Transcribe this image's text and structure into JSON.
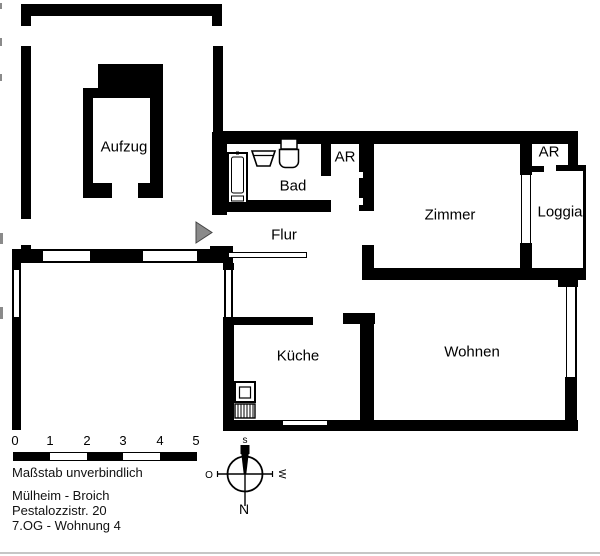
{
  "plan": {
    "title": "Wohnungsgrundriss",
    "rooms": {
      "aufzug": "Aufzug",
      "bad": "Bad",
      "ar1": "AR",
      "zimmer": "Zimmer",
      "ar2": "AR",
      "loggia": "Loggia",
      "flur": "Flur",
      "kueche": "Küche",
      "wohnen": "Wohnen"
    },
    "scale_bar": {
      "ticks": [
        "0",
        "1",
        "2",
        "3",
        "4",
        "5"
      ],
      "note": "Maßstab unverbindlich"
    },
    "address": {
      "line1": "Mülheim - Broich",
      "line2": "Pestalozzistr. 20",
      "line3": "7.OG - Wohnung 4"
    },
    "compass": {
      "top": "s",
      "left": "O",
      "right": "W",
      "bottom": "N"
    },
    "colors": {
      "wall": "#000000",
      "entrance_marker": "#8a8a8a",
      "background": "#ffffff"
    }
  }
}
